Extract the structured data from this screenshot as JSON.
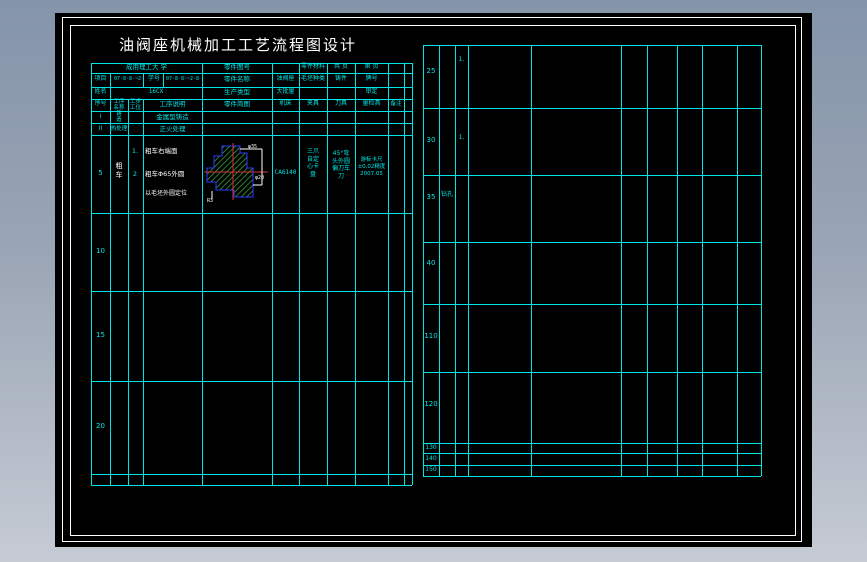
{
  "title": "油阀座机械加工工艺流程图设计",
  "process_card": {
    "school": "成用理工大 学",
    "part_no_label": "零件图号",
    "part_material_label": "零件材料",
    "pages_total_label": "共 页",
    "page_no_label": "第 页",
    "project_label": "项目",
    "project_code": "07·8·8·~2",
    "student_label": "学号",
    "student_code": "07·8·8·~2·8",
    "part_name_label": "零件名称",
    "part_name": "油阀座",
    "blank_kind_label": "毛坯种类",
    "blank_kind": "铸件",
    "grade_label": "牌号",
    "name_label": "姓名",
    "name_value": "16CX",
    "prod_type_label": "生产类型",
    "prod_type": "大批量",
    "approve_label": "审定",
    "col_headers": {
      "seq": "序号",
      "op_name": "工序\n名称",
      "station": "工步\n工位",
      "op_desc": "工序说明",
      "sketch": "零件简图",
      "machine": "机床",
      "fixture": "夹具",
      "tool": "刀具",
      "gauge": "量检具",
      "note": "备注"
    },
    "rows": {
      "r1": {
        "no": "I",
        "name": "铸\n造",
        "desc": "金属型铸造"
      },
      "r2": {
        "no": "II",
        "name": "热处理",
        "desc": "正火处理"
      },
      "r5": {
        "no": "5",
        "name": "粗\n车",
        "step1_no": "1.",
        "step1": "粗车右端面",
        "step2_no": "2",
        "step2": "粗车Φ65外圆",
        "note": "以毛坯外圆定位",
        "machine": "CA6140",
        "fixture": "三爪\n自定\n心卡\n盘",
        "tool": "45°弯\n头外圆\n偏刀车\n刀",
        "gauge": "游标卡尺\n±0.02精度\n2007.05"
      },
      "r10": "10",
      "r15": "15",
      "r20": "20"
    },
    "sketch_dims": {
      "d1": "φ35",
      "d2": "φ20",
      "d3": "R3"
    }
  },
  "continuation_table": {
    "rows": [
      {
        "no": "25",
        "step": "1."
      },
      {
        "no": "30",
        "step": "1."
      },
      {
        "no": "35",
        "name": "钻孔"
      },
      {
        "no": "40"
      },
      {
        "no": "110"
      },
      {
        "no": "120"
      },
      {
        "no": "130"
      },
      {
        "no": "140"
      },
      {
        "no": "150"
      }
    ]
  },
  "colors": {
    "grid_line": "#00e6e6",
    "text_white": "#ffffff",
    "hatch_green": "#3db53d",
    "outline_blue": "#2a3bff",
    "centerline_red": "#d43535"
  }
}
